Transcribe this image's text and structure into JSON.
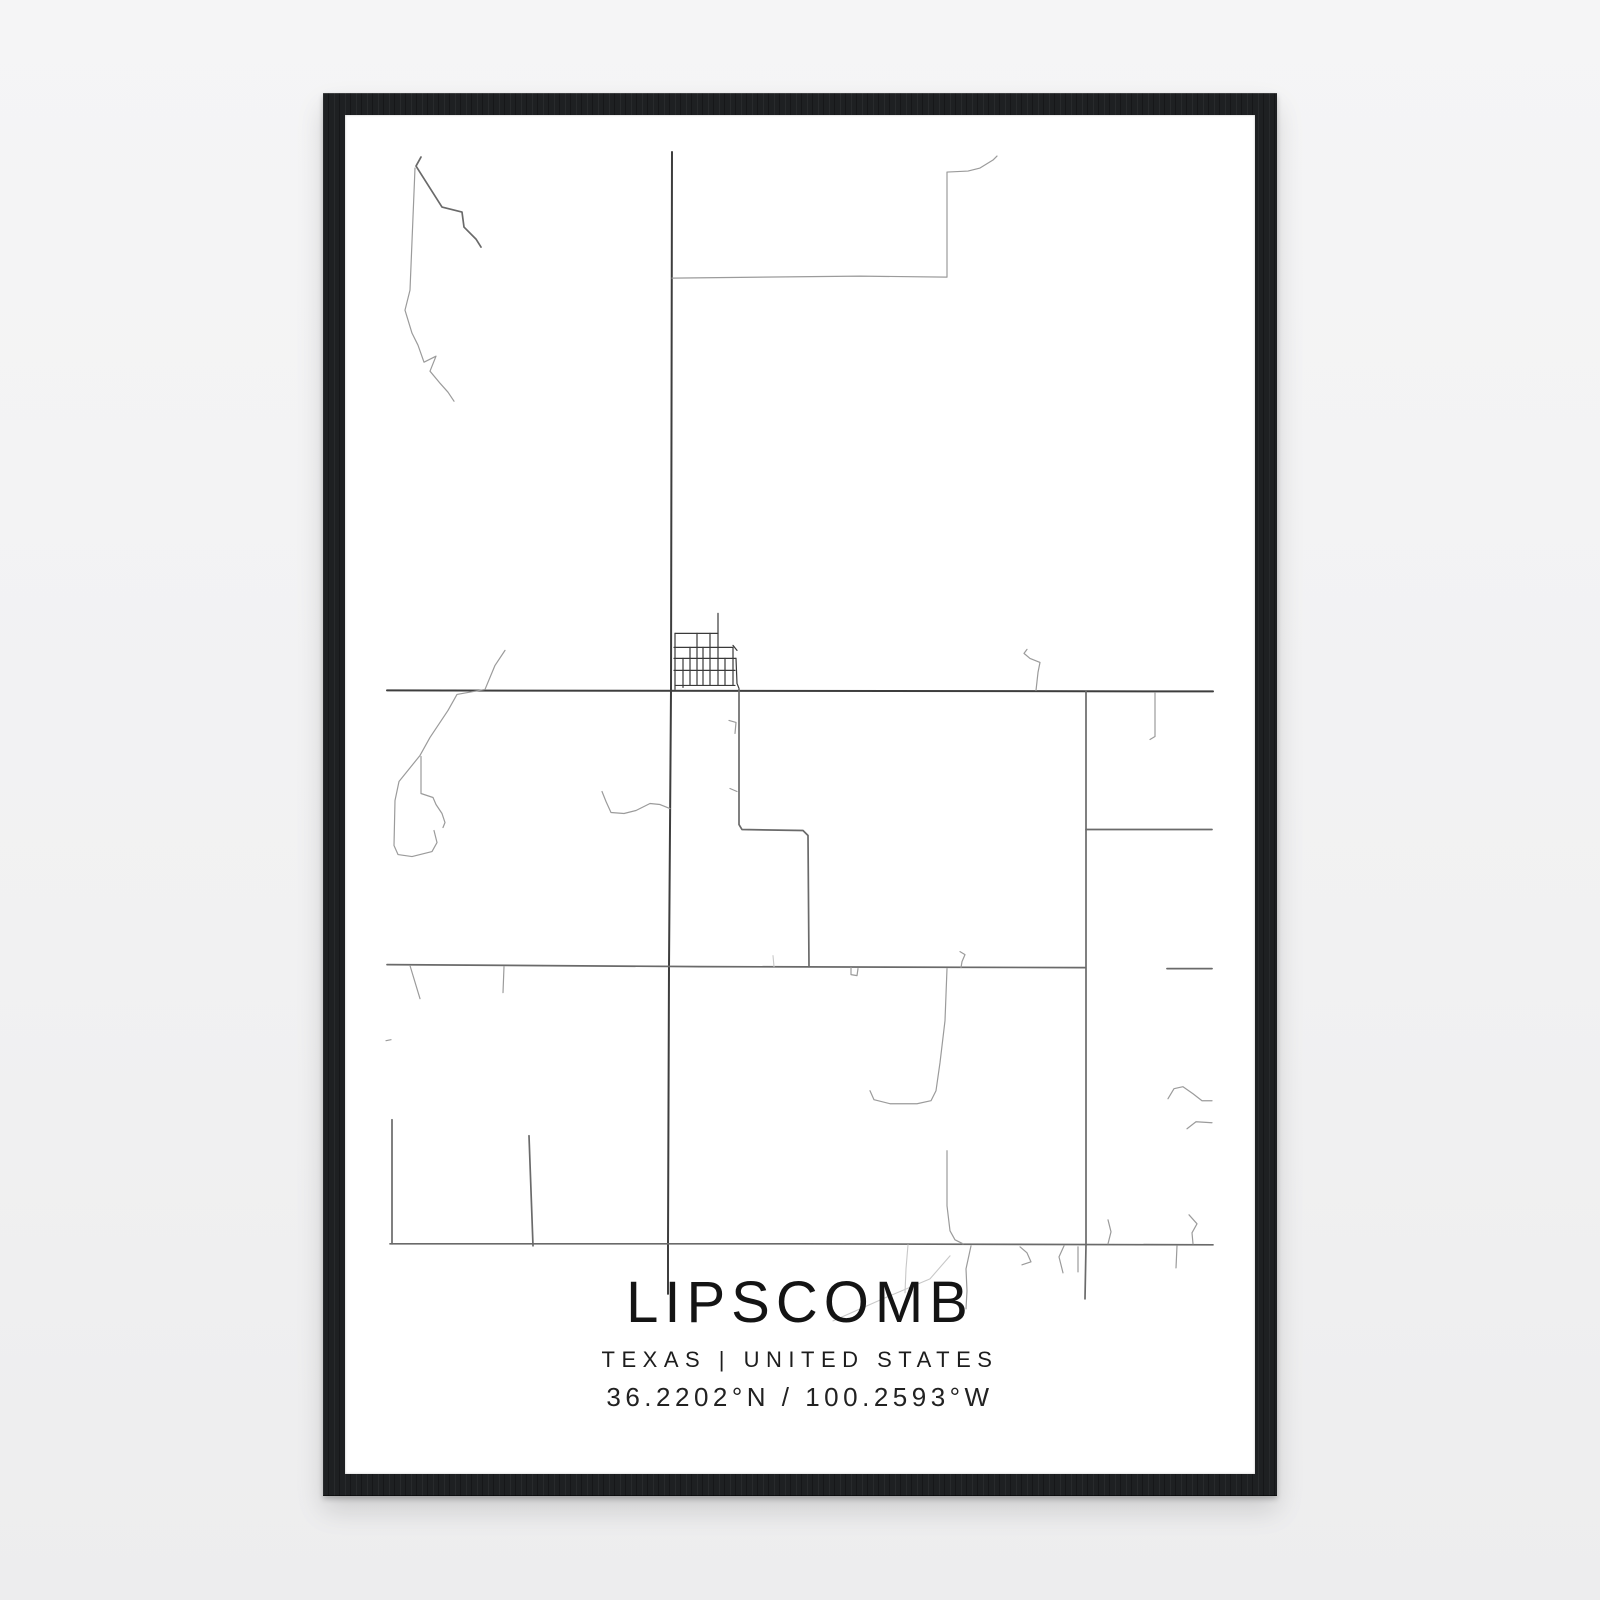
{
  "poster": {
    "title": "LIPSCOMB",
    "subtitle": "TEXAS | UNITED STATES",
    "coordinates": "36.2202°N / 100.2593°W"
  },
  "colors": {
    "background": "#f2f2f3",
    "frame": "#1e2022",
    "paper": "#ffffff",
    "text": "#161616"
  },
  "map": {
    "viewBox": "345 115 910 1358",
    "tiers": {
      "main": {
        "color": "#3e3e3e",
        "width": 2
      },
      "medium": {
        "color": "#6a6a6a",
        "width": 1.7
      },
      "grid": {
        "color": "#3a3a3a",
        "width": 1.2
      },
      "light": {
        "color": "#9b9b9b",
        "width": 1.2
      },
      "faint": {
        "color": "#c8c8c8",
        "width": 1.1
      }
    },
    "roads": [
      {
        "id": "main-vertical",
        "tier": "main",
        "points": [
          [
            672,
            152
          ],
          [
            671,
            690
          ],
          [
            669,
            966
          ],
          [
            668,
            1244
          ],
          [
            668,
            1293
          ]
        ]
      },
      {
        "id": "highway-upper",
        "tier": "main",
        "points": [
          [
            387,
            690
          ],
          [
            1213,
            691
          ]
        ]
      },
      {
        "id": "highway-middle",
        "tier": "medium",
        "points": [
          [
            387,
            964
          ],
          [
            700,
            966
          ],
          [
            1085,
            967
          ]
        ]
      },
      {
        "id": "highway-middle-right-dash",
        "tier": "medium",
        "points": [
          [
            1167,
            968
          ],
          [
            1212,
            968
          ]
        ]
      },
      {
        "id": "highway-lower",
        "tier": "medium",
        "points": [
          [
            390,
            1243
          ],
          [
            800,
            1243
          ],
          [
            1213,
            1244
          ]
        ]
      },
      {
        "id": "right-vertical",
        "tier": "medium",
        "points": [
          [
            1086,
            691
          ],
          [
            1086,
            1244
          ],
          [
            1085,
            1298
          ]
        ]
      },
      {
        "id": "town-south-connector",
        "tier": "medium",
        "points": [
          [
            739,
            689
          ],
          [
            739,
            824
          ],
          [
            742,
            829
          ],
          [
            803,
            830
          ],
          [
            808,
            835
          ],
          [
            809,
            966
          ]
        ]
      },
      {
        "id": "left-bottom-vertical",
        "tier": "medium",
        "points": [
          [
            392,
            1119
          ],
          [
            392,
            1243
          ]
        ]
      },
      {
        "id": "bottom-slant-road",
        "tier": "medium",
        "points": [
          [
            529,
            1135
          ],
          [
            533,
            1245
          ]
        ]
      },
      {
        "id": "right-mid-horizontal",
        "tier": "medium",
        "points": [
          [
            1086,
            829
          ],
          [
            1212,
            829
          ]
        ]
      },
      {
        "id": "grid-stub-top",
        "tier": "grid",
        "points": [
          [
            718,
            613
          ],
          [
            718,
            633
          ]
        ]
      },
      {
        "id": "grid-h1",
        "tier": "grid",
        "points": [
          [
            675,
            633
          ],
          [
            718,
            633
          ]
        ]
      },
      {
        "id": "grid-h2",
        "tier": "grid",
        "points": [
          [
            674,
            647
          ],
          [
            733,
            647
          ]
        ]
      },
      {
        "id": "grid-h3",
        "tier": "grid",
        "points": [
          [
            674,
            658
          ],
          [
            736,
            658
          ]
        ]
      },
      {
        "id": "grid-h4",
        "tier": "grid",
        "points": [
          [
            674,
            670
          ],
          [
            735,
            670
          ]
        ]
      },
      {
        "id": "grid-h5",
        "tier": "grid",
        "points": [
          [
            675,
            685
          ],
          [
            735,
            685
          ]
        ]
      },
      {
        "id": "grid-v1",
        "tier": "grid",
        "points": [
          [
            675,
            633
          ],
          [
            675,
            689
          ]
        ]
      },
      {
        "id": "grid-v2",
        "tier": "grid",
        "points": [
          [
            683,
            658
          ],
          [
            683,
            687
          ]
        ]
      },
      {
        "id": "grid-v3",
        "tier": "grid",
        "points": [
          [
            690,
            647
          ],
          [
            690,
            685
          ]
        ]
      },
      {
        "id": "grid-v4",
        "tier": "grid",
        "points": [
          [
            697,
            633
          ],
          [
            697,
            685
          ]
        ]
      },
      {
        "id": "grid-v5",
        "tier": "grid",
        "points": [
          [
            703,
            647
          ],
          [
            703,
            685
          ]
        ]
      },
      {
        "id": "grid-v6",
        "tier": "grid",
        "points": [
          [
            710,
            633
          ],
          [
            710,
            685
          ]
        ]
      },
      {
        "id": "grid-v7",
        "tier": "grid",
        "points": [
          [
            718,
            633
          ],
          [
            718,
            685
          ]
        ]
      },
      {
        "id": "grid-v8",
        "tier": "grid",
        "points": [
          [
            725,
            658
          ],
          [
            725,
            685
          ]
        ]
      },
      {
        "id": "grid-v9",
        "tier": "grid",
        "points": [
          [
            733,
            647
          ],
          [
            733,
            685
          ]
        ]
      },
      {
        "id": "grid-tick",
        "tier": "grid",
        "points": [
          [
            733,
            645
          ],
          [
            737,
            650
          ]
        ]
      },
      {
        "id": "grid-east-edge",
        "tier": "grid",
        "points": [
          [
            736,
            658
          ],
          [
            737,
            683
          ],
          [
            739,
            688
          ]
        ]
      },
      {
        "id": "nw-diagonal-dark",
        "tier": "medium",
        "points": [
          [
            421,
            157
          ],
          [
            416,
            166
          ],
          [
            442,
            207
          ],
          [
            462,
            212
          ],
          [
            464,
            227
          ],
          [
            476,
            239
          ],
          [
            481,
            247
          ]
        ]
      },
      {
        "id": "nw-creek",
        "tier": "light",
        "points": [
          [
            415,
            168
          ],
          [
            410,
            290
          ],
          [
            405,
            310
          ],
          [
            412,
            333
          ],
          [
            418,
            345
          ],
          [
            424,
            362
          ],
          [
            436,
            356
          ],
          [
            430,
            371
          ],
          [
            440,
            383
          ],
          [
            448,
            392
          ],
          [
            454,
            401
          ]
        ]
      },
      {
        "id": "north-loop-road",
        "tier": "light",
        "points": [
          [
            672,
            278
          ],
          [
            860,
            276
          ],
          [
            947,
            277
          ],
          [
            947,
            172
          ],
          [
            968,
            171
          ],
          [
            980,
            168
          ],
          [
            993,
            160
          ],
          [
            997,
            156
          ]
        ]
      },
      {
        "id": "squiggle-above-h1",
        "tier": "light",
        "points": [
          [
            1027,
            649
          ],
          [
            1024,
            653
          ],
          [
            1030,
            658
          ],
          [
            1040,
            662
          ],
          [
            1038,
            672
          ],
          [
            1036,
            690
          ]
        ]
      },
      {
        "id": "tick-below-h1-right",
        "tier": "light",
        "points": [
          [
            1155,
            692
          ],
          [
            1155,
            736
          ],
          [
            1150,
            739
          ]
        ]
      },
      {
        "id": "tick-connector-1",
        "tier": "light",
        "points": [
          [
            729,
            720
          ],
          [
            736,
            722
          ],
          [
            735,
            733
          ]
        ]
      },
      {
        "id": "tick-connector-2",
        "tier": "light",
        "points": [
          [
            730,
            788
          ],
          [
            737,
            791
          ]
        ]
      },
      {
        "id": "west-creek-main",
        "tier": "light",
        "points": [
          [
            505,
            650
          ],
          [
            495,
            665
          ],
          [
            485,
            689
          ],
          [
            457,
            694
          ],
          [
            448,
            710
          ],
          [
            430,
            737
          ],
          [
            420,
            755
          ],
          [
            399,
            781
          ],
          [
            395,
            800
          ],
          [
            394,
            845
          ],
          [
            398,
            854
          ],
          [
            412,
            856
          ],
          [
            432,
            851
          ],
          [
            437,
            842
          ],
          [
            434,
            830
          ]
        ]
      },
      {
        "id": "west-creek-branch",
        "tier": "light",
        "points": [
          [
            421,
            756
          ],
          [
            421,
            793
          ],
          [
            433,
            797
          ],
          [
            436,
            804
          ],
          [
            442,
            813
          ],
          [
            445,
            822
          ],
          [
            443,
            827
          ]
        ]
      },
      {
        "id": "mid-creek-to-v1",
        "tier": "light",
        "points": [
          [
            602,
            791
          ],
          [
            606,
            801
          ],
          [
            611,
            812
          ],
          [
            624,
            813
          ],
          [
            636,
            810
          ],
          [
            650,
            803
          ],
          [
            660,
            804
          ],
          [
            670,
            808
          ]
        ]
      },
      {
        "id": "east-creek-from-h2",
        "tier": "light",
        "points": [
          [
            947,
            968
          ],
          [
            945,
            1020
          ],
          [
            940,
            1062
          ],
          [
            936,
            1090
          ],
          [
            931,
            1100
          ],
          [
            917,
            1103
          ],
          [
            890,
            1103
          ],
          [
            874,
            1099
          ],
          [
            870,
            1090
          ]
        ]
      },
      {
        "id": "east-creek-to-h4",
        "tier": "light",
        "points": [
          [
            947,
            1150
          ],
          [
            947,
            1205
          ],
          [
            950,
            1230
          ],
          [
            955,
            1239
          ],
          [
            963,
            1243
          ]
        ]
      },
      {
        "id": "creek-below-h4",
        "tier": "light",
        "points": [
          [
            971,
            1245
          ],
          [
            966,
            1268
          ],
          [
            967,
            1290
          ],
          [
            966,
            1308
          ]
        ]
      },
      {
        "id": "right-wave-1",
        "tier": "light",
        "points": [
          [
            1168,
            1098
          ],
          [
            1174,
            1088
          ],
          [
            1183,
            1086
          ],
          [
            1193,
            1093
          ],
          [
            1202,
            1100
          ],
          [
            1212,
            1100
          ]
        ]
      },
      {
        "id": "right-wave-2",
        "tier": "light",
        "points": [
          [
            1187,
            1128
          ],
          [
            1196,
            1121
          ],
          [
            1212,
            1122
          ]
        ]
      },
      {
        "id": "tick-above-h4-1",
        "tier": "light",
        "points": [
          [
            1108,
            1219
          ],
          [
            1111,
            1231
          ],
          [
            1108,
            1243
          ]
        ]
      },
      {
        "id": "tick-above-h4-2",
        "tier": "light",
        "points": [
          [
            1189,
            1214
          ],
          [
            1197,
            1223
          ],
          [
            1192,
            1232
          ],
          [
            1193,
            1243
          ]
        ]
      },
      {
        "id": "tick-below-h4-1",
        "tier": "light",
        "points": [
          [
            1020,
            1246
          ],
          [
            1027,
            1252
          ],
          [
            1031,
            1261
          ],
          [
            1022,
            1264
          ]
        ]
      },
      {
        "id": "tick-below-h4-2",
        "tier": "light",
        "points": [
          [
            1064,
            1245
          ],
          [
            1059,
            1256
          ],
          [
            1063,
            1272
          ]
        ]
      },
      {
        "id": "tick-below-h4-3",
        "tier": "light",
        "points": [
          [
            1078,
            1246
          ],
          [
            1078,
            1271
          ]
        ]
      },
      {
        "id": "tick-below-h4-4",
        "tier": "light",
        "points": [
          [
            1177,
            1245
          ],
          [
            1176,
            1267
          ]
        ]
      },
      {
        "id": "tick-below-h2-1",
        "tier": "light",
        "points": [
          [
            410,
            965
          ],
          [
            420,
            998
          ]
        ]
      },
      {
        "id": "tick-below-h2-2",
        "tier": "light",
        "points": [
          [
            504,
            966
          ],
          [
            503,
            992
          ]
        ]
      },
      {
        "id": "dash-left",
        "tier": "light",
        "points": [
          [
            386,
            1040
          ],
          [
            391,
            1039
          ]
        ]
      },
      {
        "id": "u-tick-h2",
        "tier": "light",
        "points": [
          [
            851,
            967
          ],
          [
            851,
            974
          ],
          [
            857,
            975
          ],
          [
            858,
            968
          ]
        ]
      },
      {
        "id": "hook-crossing-h2",
        "tier": "light",
        "points": [
          [
            960,
            951
          ],
          [
            965,
            954
          ],
          [
            962,
            961
          ],
          [
            961,
            967
          ]
        ]
      },
      {
        "id": "faint-curve-caption",
        "tier": "faint",
        "points": [
          [
            833,
            1320
          ],
          [
            885,
            1297
          ],
          [
            930,
            1278
          ],
          [
            950,
            1255
          ]
        ]
      },
      {
        "id": "faint-below-h4",
        "tier": "faint",
        "points": [
          [
            908,
            1244
          ],
          [
            906,
            1268
          ],
          [
            905,
            1292
          ]
        ]
      },
      {
        "id": "faint-tick-h2",
        "tier": "faint",
        "points": [
          [
            773,
            955
          ],
          [
            774,
            966
          ]
        ]
      }
    ]
  }
}
